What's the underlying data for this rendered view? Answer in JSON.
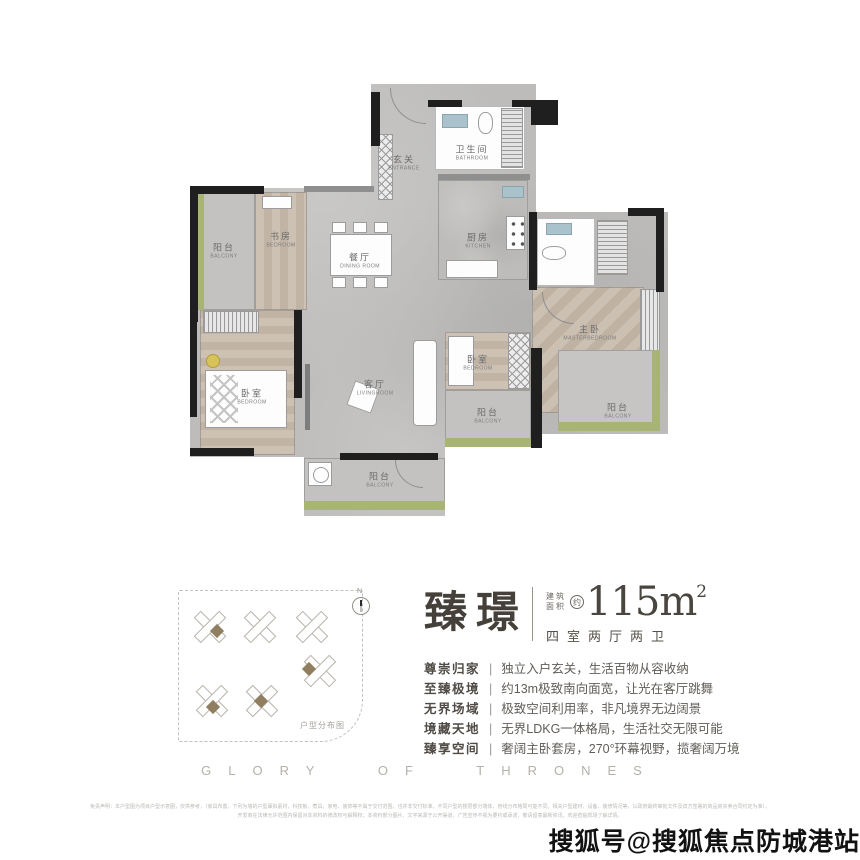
{
  "floorplan": {
    "rooms": [
      {
        "zh": "玄关",
        "en": "ENTRANCE"
      },
      {
        "zh": "卫生间",
        "en": "BATHROOM"
      },
      {
        "zh": "阳台",
        "en": "BALCONY"
      },
      {
        "zh": "书房",
        "en": "BEDROOM"
      },
      {
        "zh": "餐厅",
        "en": "DINING ROOM"
      },
      {
        "zh": "厨房",
        "en": "KITCHEN"
      },
      {
        "zh": "主卧",
        "en": "MASTERBEDROOM"
      },
      {
        "zh": "卧室",
        "en": "BEDROOM"
      },
      {
        "zh": "客厅",
        "en": "LIVINGROOM"
      },
      {
        "zh": "卧室",
        "en": "BEDROOM"
      },
      {
        "zh": "阳台",
        "en": "BALCONY"
      },
      {
        "zh": "阳台",
        "en": "BALCONY"
      },
      {
        "zh": "阳台",
        "en": "BALCONY"
      }
    ]
  },
  "siteplan": {
    "label": "户型分布图",
    "compass": "N"
  },
  "header": {
    "name": "臻璟",
    "area_prefix_top": "建筑",
    "area_prefix_bottom": "面积",
    "approx": "约",
    "area_value": "115m",
    "area_sup": "2",
    "layout": "四室两厅两卫"
  },
  "features": [
    {
      "tag": "尊崇归家",
      "sep": "|",
      "desc": "独立入户玄关，生活百物从容收纳"
    },
    {
      "tag": "至臻极境",
      "sep": "|",
      "desc": "约13m极致南向面宽，让光在客厅跳舞"
    },
    {
      "tag": "无界场域",
      "sep": "|",
      "desc": "极致空间利用率，非凡境界无边阔景"
    },
    {
      "tag": "境藏天地",
      "sep": "|",
      "desc": "无界LDKG一体格局，生活社交无限可能"
    },
    {
      "tag": "臻享空间",
      "sep": "|",
      "desc": "奢阔主卧套房，270°环幕视野，揽奢阔万境"
    }
  ],
  "footer": {
    "slogan": "GLORY OF THRONES",
    "disclaimer_line1": "免责声明：本户型图为项目户型示意图，仅供参考，（家具布置、下列为墙的户型摹拟素材，科技板、煮具、家电、装饰等不属于交付范围，也并非交付标准，不同户型的楼层部分墙体、管线分布格局可能不同，相关户型建材、设备、装修情况等，以政府最终审批文件及双方签署的商品房买卖合同约定为准）。",
    "disclaimer_line2": "开发商在法律允许范围内保留对本资料的修改权与解释权；本资料部分图片、文字来源于公开渠道，广告宣传不视为要约或承诺，敬请留意最新资讯，欢迎莅临现场了解详情。"
  },
  "watermark": "搜狐号@搜狐焦点防城港站",
  "colors": {
    "balcony_green": "#a8b476",
    "wood": "#c9bcae",
    "floor_gray": "#bdbcba",
    "wall_black": "#1f1f1f",
    "highlight_unit_brown": "#907e60"
  }
}
